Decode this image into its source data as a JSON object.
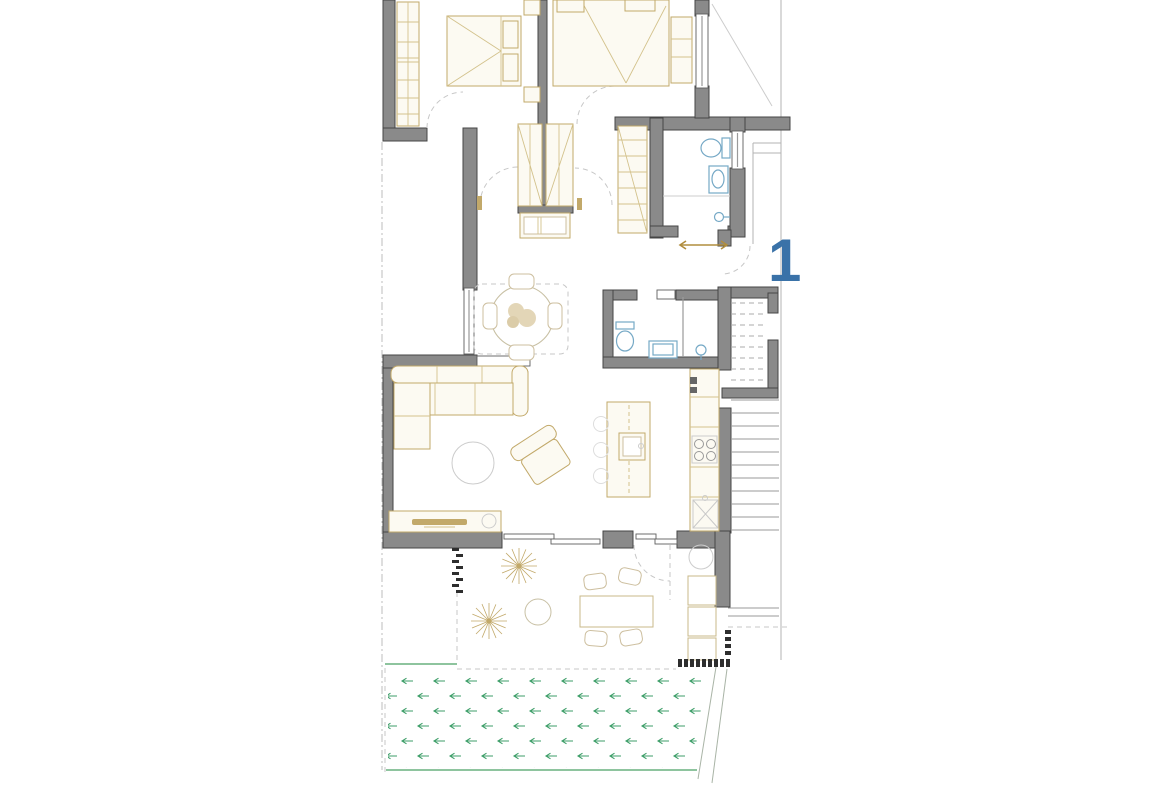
{
  "window": {
    "width": 1170,
    "height": 785,
    "background": "#ffffff"
  },
  "plan": {
    "kind": "apartment-floor-plan",
    "unit_label": "1",
    "unit_label_color": "#3a72a8",
    "palette": {
      "wall_fill": "#8a8a8a",
      "wall_outline": "#454545",
      "furniture_line": "#c2a96a",
      "furniture_fill": "#fcfaf2",
      "fixture_blue": "#76a9c6",
      "grass_green": "#3d9e68",
      "lawn_border_green": "#69b07e",
      "fence_black": "#2e2e2e",
      "boundary_gray": "#b3b3b3"
    },
    "rooms": [
      {
        "name": "bedroom-1",
        "furniture": [
          "double-bed",
          "wardrobe",
          "nightstands"
        ]
      },
      {
        "name": "bedroom-2",
        "furniture": [
          "double-bed",
          "dresser"
        ]
      },
      {
        "name": "hallway",
        "furniture": [
          "wardrobe",
          "wardrobe",
          "dresser",
          "tall-wardrobe"
        ]
      },
      {
        "name": "bathroom-1",
        "furniture": [
          "toilet",
          "washbasin",
          "shower"
        ]
      },
      {
        "name": "dining-area",
        "furniture": [
          "round-table",
          "four-chairs",
          "plant-centerpiece"
        ]
      },
      {
        "name": "bathroom-2",
        "furniture": [
          "toilet",
          "washbasin",
          "shower-stall"
        ]
      },
      {
        "name": "staircase",
        "furniture": [
          "upper-flight-dashed",
          "lower-flight-treads"
        ]
      },
      {
        "name": "living-room",
        "furniture": [
          "corner-sofa",
          "armchair",
          "coffee-table",
          "tv-sideboard"
        ]
      },
      {
        "name": "kitchen",
        "furniture": [
          "island-with-sink",
          "bar-stools",
          "counter",
          "cooktop",
          "sink"
        ]
      },
      {
        "name": "terrace",
        "furniture": [
          "palm-tree",
          "palm-tree",
          "round-table",
          "outdoor-dining-table",
          "four-chairs",
          "planters"
        ]
      },
      {
        "name": "garden-lawn",
        "furniture": [
          "grass-field"
        ]
      }
    ]
  }
}
